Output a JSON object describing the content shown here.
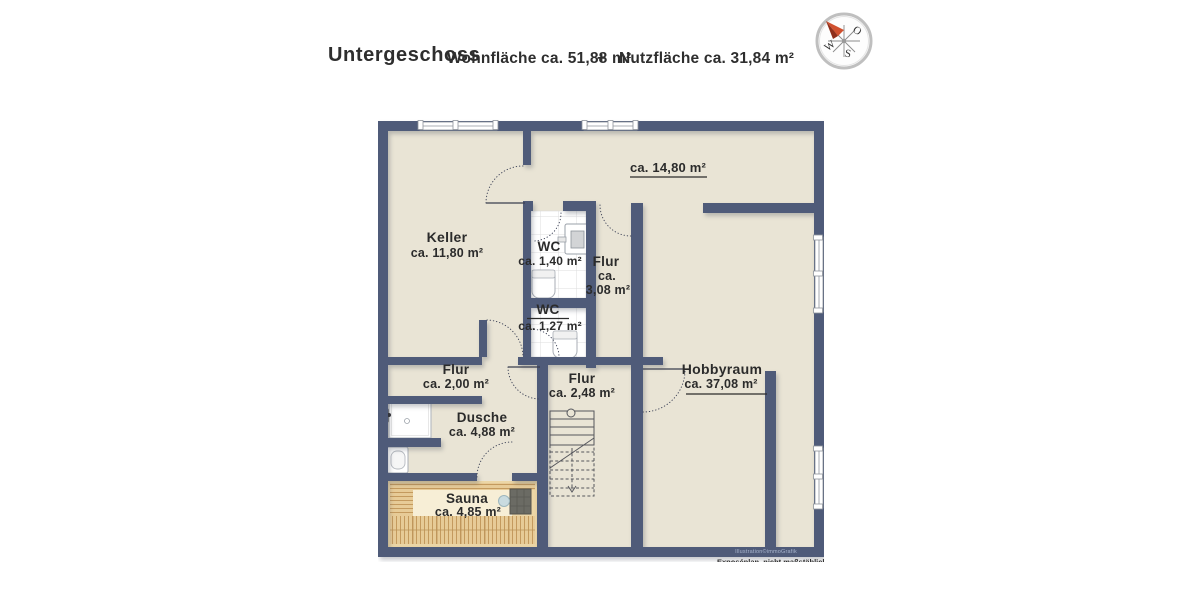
{
  "header": {
    "title": "Untergeschoss",
    "living_area": "Wohnfläche ca. 51,88 m²",
    "plus_sign": "+",
    "usable_area": "Nutzfläche ca. 31,84 m²"
  },
  "compass": {
    "east_label": "O",
    "west_label": "W",
    "south_label": "S"
  },
  "plan": {
    "top_room": {
      "area": "ca. 14,80 m²"
    },
    "keller": {
      "name": "Keller",
      "area": "ca. 11,80 m²"
    },
    "wc_upper": {
      "name": "WC",
      "area": "ca. 1,40 m²"
    },
    "flur_wc": {
      "name": "Flur",
      "area_prefix": "ca.",
      "area_value": "3,08 m²"
    },
    "wc_lower": {
      "name": "WC",
      "area": "ca. 1,27 m²"
    },
    "flur_west": {
      "name": "Flur",
      "area": "ca. 2,00 m²"
    },
    "flur_center": {
      "name": "Flur",
      "area": "ca. 2,48 m²"
    },
    "hobbyraum": {
      "name": "Hobbyraum",
      "area": "ca. 37,08 m²"
    },
    "dusche": {
      "name": "Dusche",
      "area": "ca. 4,88 m²"
    },
    "sauna": {
      "name": "Sauna",
      "area": "ca. 4,85 m²"
    }
  },
  "footer": {
    "credit": "Illustration©immoGrafik",
    "disclaimer": "Exposéplan, nicht maßstäblich"
  },
  "colors": {
    "wall": "#4f5b79",
    "floor": "#e9e4d5",
    "tile_line": "#dcdcde",
    "wood": "#e7cb97",
    "wood_line": "#c49a5e",
    "sauna_center": "#f7eed6",
    "stove": "#6b6b64",
    "compass_arrow": "#d0502e",
    "text": "#2b2b2b",
    "credit_text": "#a9b6ce"
  }
}
